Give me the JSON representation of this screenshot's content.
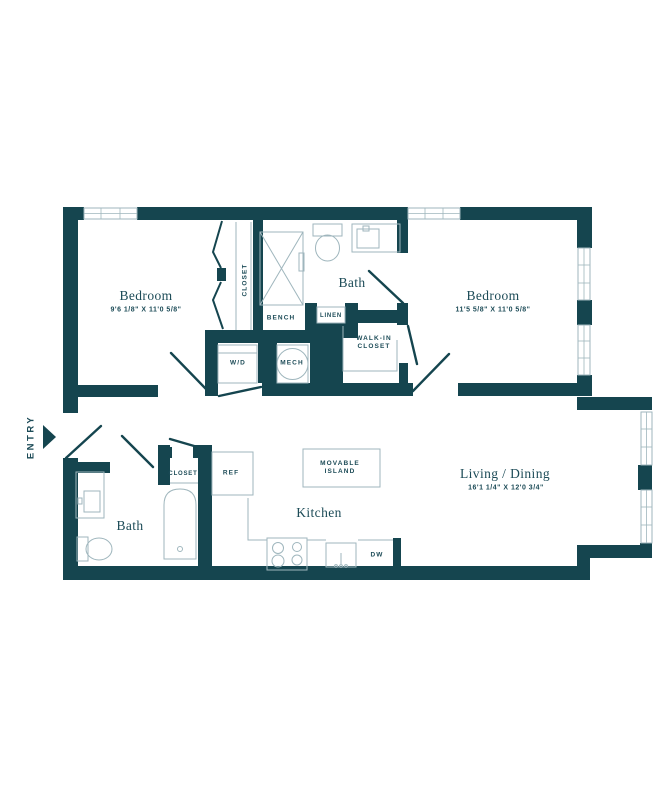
{
  "colors": {
    "wall": "#15454F",
    "line": "#9FB6BD",
    "text": "#1C4B57",
    "bg": "#FFFFFF"
  },
  "entry": {
    "label": "ENTRY"
  },
  "rooms": {
    "bedroom_left": {
      "name": "Bedroom",
      "dims": "9'6 1/8\" X 11'0 5/8\""
    },
    "bedroom_right": {
      "name": "Bedroom",
      "dims": "11'5 5/8\" X 11'0 5/8\""
    },
    "bath_upper": {
      "name": "Bath"
    },
    "bath_lower": {
      "name": "Bath"
    },
    "kitchen": {
      "name": "Kitchen"
    },
    "living_dining": {
      "name": "Living / Dining",
      "dims": "16'1 1/4\" X 12'0 3/4\""
    }
  },
  "labels": {
    "closet_upper": "CLOSET",
    "bench": "BENCH",
    "linen": "LINEN",
    "walk_in_1": "WALK-IN",
    "walk_in_2": "CLOSET",
    "wd": "W/D",
    "mech": "MECH",
    "ref": "REF",
    "island_1": "MOVABLE",
    "island_2": "ISLAND",
    "dw": "DW",
    "closet_lower": "CLOSET"
  }
}
